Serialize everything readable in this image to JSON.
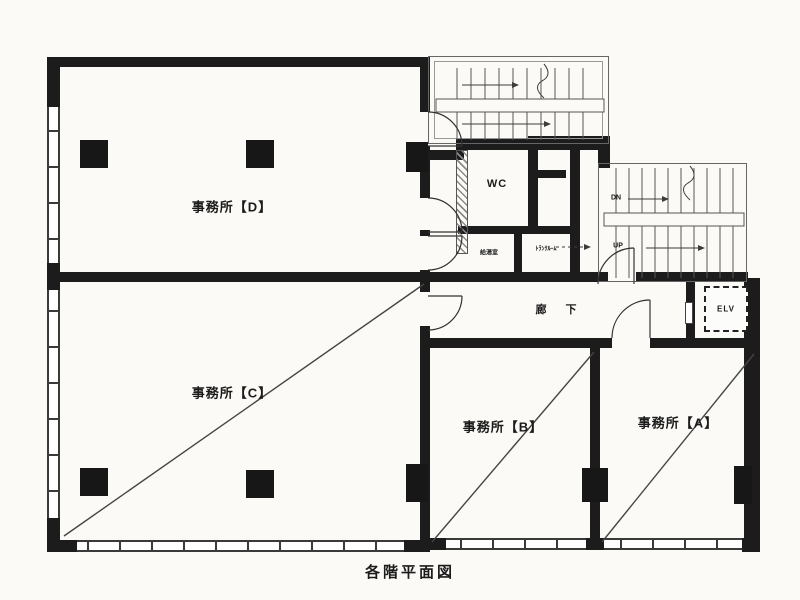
{
  "caption": "各階平面図",
  "rooms": {
    "office_d": {
      "label": "事務所【D】"
    },
    "office_c": {
      "label": "事務所【C】"
    },
    "office_b": {
      "label": "事務所【B】"
    },
    "office_a": {
      "label": "事務所【A】"
    },
    "wc": {
      "label": "WC"
    },
    "corridor": {
      "label": "廊 下"
    },
    "elevator": {
      "label": "ELV"
    },
    "kitchenette": {
      "label": "給湯室"
    },
    "storage": {
      "label": "ﾄﾗﾝｸﾙｰﾑ"
    }
  },
  "stairs": {
    "down_label": "DN",
    "up_label": "UP"
  },
  "colors": {
    "wall": "#1c1c1c",
    "paper": "#fbfaf6",
    "line": "#3c3c3c"
  }
}
